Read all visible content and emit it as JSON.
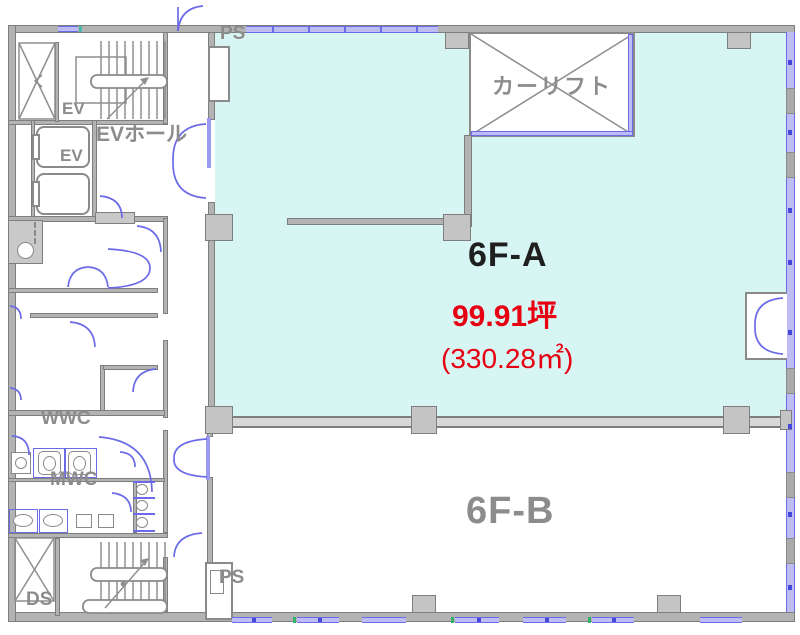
{
  "title": "6F floor plan",
  "units": {
    "a": {
      "label": "6F-A",
      "area_tsubo": "99.91坪",
      "area_m2": "(330.28㎡)"
    },
    "b": {
      "label": "6F-B"
    }
  },
  "rooms": {
    "car_lift": "カーリフト",
    "ev_hall": "EVホール",
    "ev_upper": "EV",
    "ev_lower": "EV",
    "wwc": "WWC",
    "mwc": "MWC",
    "ds": "DS",
    "ps_top": "PS",
    "ps_bottom": "PS"
  },
  "colors": {
    "cyan": "#d7f5f3",
    "wall": "#b3b3b3",
    "wallDark": "#7e7e7e",
    "wallLight": "#c9c9c9",
    "colFill": "#c4c4c4",
    "blue": "#6b6be8",
    "lavender": "#bdbdf4",
    "labelGray": "#8c8c8c",
    "red": "#e60012",
    "black": "#1f1f1f",
    "green": "#35b06a"
  }
}
